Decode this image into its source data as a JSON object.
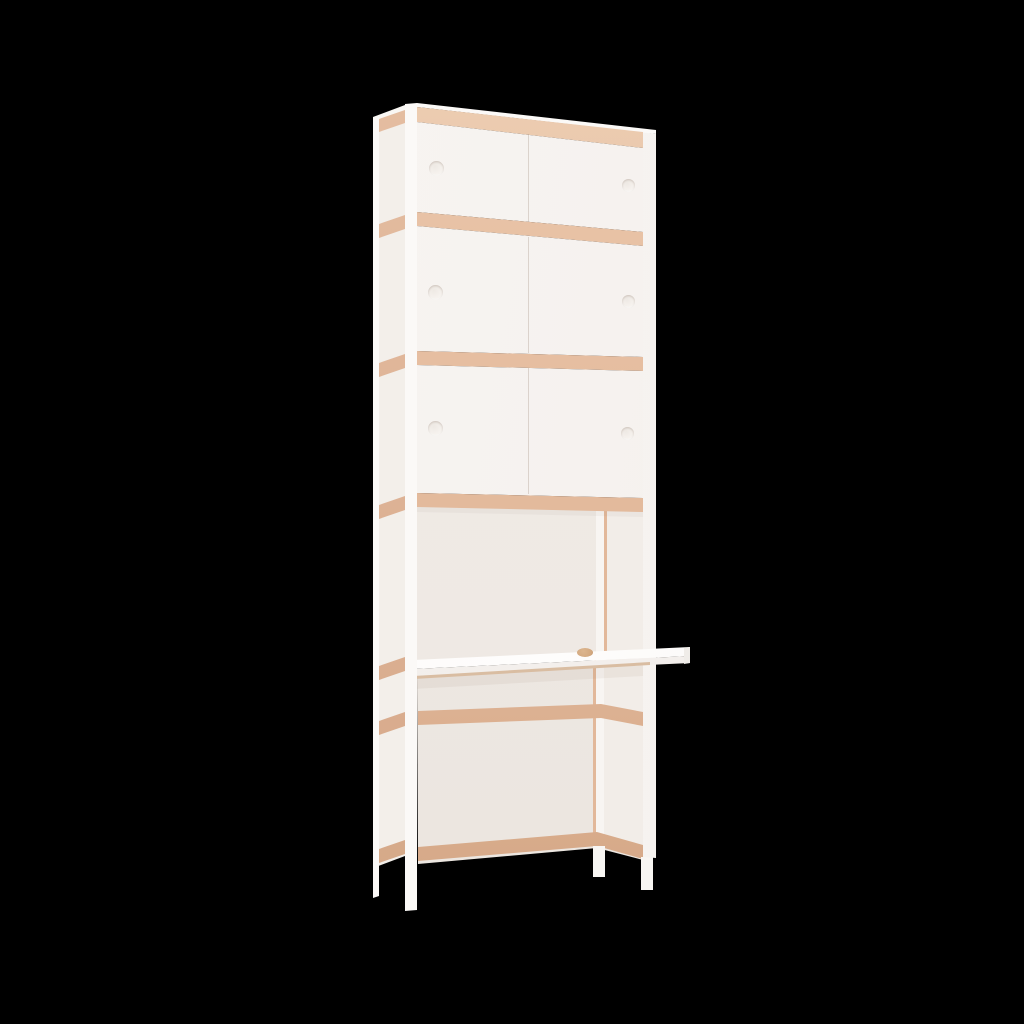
{
  "scene": {
    "description": "3D product render of a tall narrow white storage shelf with exposed plywood edge strips and an integrated pull-out style desk surface, standing on slim white legs against a solid black background",
    "object": "shelf-and-desk unit",
    "view": "three-quarter front-left product view",
    "structure": {
      "sliding_door_sections": 3,
      "finger_holes_per_section": 2,
      "finger_holes_total": 6,
      "plywood_edge_strips_front": 4,
      "plywood_edge_strips_side": 7,
      "open_compartments": 2,
      "desk": {
        "overhangs_right_side": true,
        "cable_grommet": true
      },
      "visible_legs": 4
    }
  },
  "colors": {
    "bg": "#000000",
    "wood_light": "#ecc9ad",
    "wood": "#e2b89a",
    "wood_dark": "#d5a887",
    "wood_edge": "#c49a7c",
    "wood_side_light": "#e6c0a4",
    "wood_side": "#dcb093",
    "door_light": "#f9f6f4",
    "door_dark": "#f3efeb",
    "stile": "#fbf9f7",
    "side_panel": "#f2eee9",
    "back_panel": "#f0ebe6",
    "right_wall": "#f2ede8",
    "post": "#f8f5f2",
    "desk_top": "#fefdfc",
    "desk_edge": "#f6f3f0",
    "desk_underline": "#d9bda2",
    "grommet": "#d3a87f",
    "leg": "#f8f6f3",
    "leg_tip": "#e7e3df",
    "hole": "#f6f2ee",
    "seam": "rgba(180,162,150,0.4)"
  }
}
